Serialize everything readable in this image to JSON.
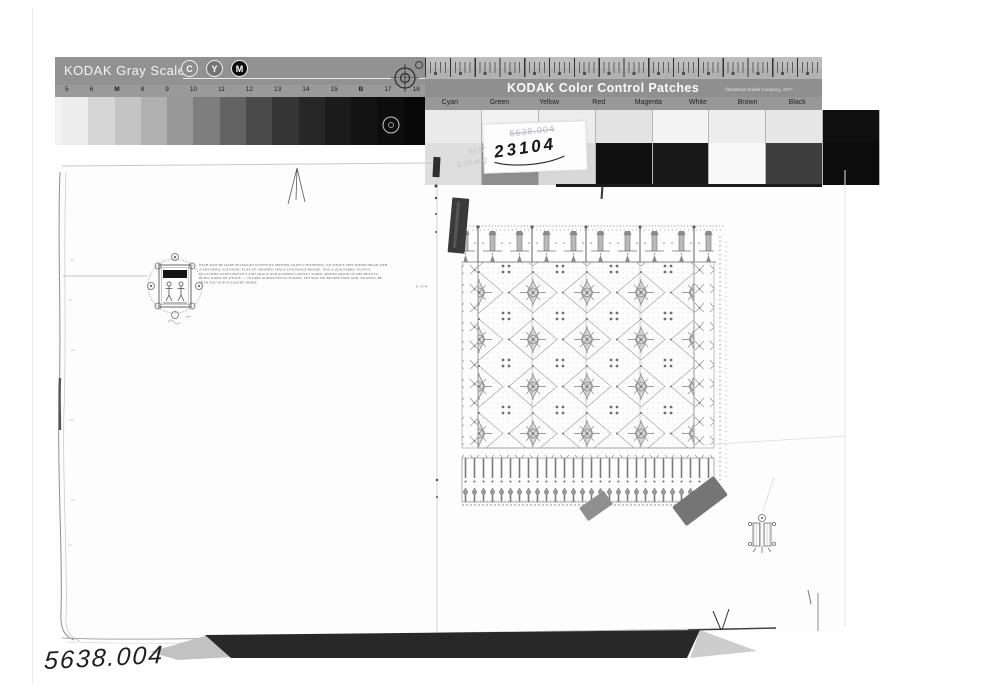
{
  "photo_label": {
    "bottom_left_number": "5638.004"
  },
  "gray_scale": {
    "title": "KODAK Gray Scale",
    "cym": [
      "C",
      "Y",
      "M"
    ],
    "cym_colors": [
      "#8c8c8c",
      "#747474",
      "#0d0d0d"
    ],
    "steps": [
      "5",
      "6",
      "M",
      "8",
      "9",
      "10",
      "11",
      "12",
      "13",
      "14",
      "15",
      "B",
      "17",
      "18"
    ],
    "patch_grays": [
      "#ededed",
      "#d6d6d6",
      "#c4c4c4",
      "#b0b0b0",
      "#989898",
      "#7e7e7e",
      "#636363",
      "#4a4a4a",
      "#363636",
      "#272727",
      "#1b1b1b",
      "#131313",
      "#0d0d0d",
      "#080808"
    ]
  },
  "color_patches": {
    "title": "KODAK Color Control Patches",
    "copyright": "©Eastman Kodak Company, 1977",
    "labels": [
      "Cyan",
      "Green",
      "Yellow",
      "Red",
      "Magenta",
      "White",
      "Brown",
      "Black"
    ],
    "row1_grays": [
      "#eaeaea",
      "#f2f2f2",
      "#ededed",
      "#e3e3e3",
      "#f4f4f4",
      "#ededed",
      "#e7e7e7",
      "#101010"
    ],
    "row2_grays": [
      "#dedede",
      "#8e8e8e",
      "#d8d8d8",
      "#101010",
      "#181818",
      "#f8f8f8",
      "#3e3e3e",
      "#0c0c0c"
    ]
  },
  "annotations": {
    "sticker_faint_number": "5638.004",
    "sticker_bold_number": "23104",
    "pencil_note_line1": "5132",
    "pencil_note_line2": "4.30 neg"
  },
  "left_page": {
    "colophon_lines": [
      "WITH NATURE WARP OF IMAGES WOVEN BY PRINTER CRAFT UNWINDING, WE WEAVE THIS INTERLINEAR WEB",
      "A RHYTHMIC SOUNDING PLAY OF ORDERED SPACE AND IMAGE BESIDE, TRACE OUR FABRIC WOVEN,",
      "TO CLOTHE WITH CHASTITY AND GRACE OUR AUTHOR'S GENTLE WORD.  APPRECIATION OF THE BEAUTY",
      "IN HIS WORK WE WEAVE, — IN PART OURSELVES TO PLEASE, YET MAY WE BETTER FARE AND, WEAVING BE",
      "WITH YOU OUR PLEASURE SHARE."
    ],
    "colophon_signature": "E. JF W"
  }
}
